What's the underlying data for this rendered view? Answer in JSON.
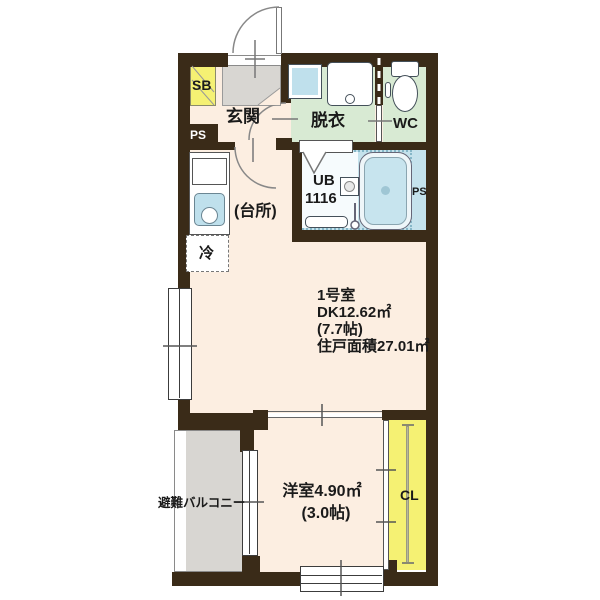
{
  "floorplan": {
    "unit_info": {
      "room_number": "1号室",
      "dk_area": "DK12.62㎡",
      "dk_tatami": "(7.7帖)",
      "total_area": "住戸面積27.01㎡"
    },
    "rooms": {
      "entrance": "玄関",
      "dressing_room": "脱衣",
      "toilet": "WC",
      "unit_bath_line1": "UB",
      "unit_bath_line2": "1116",
      "kitchen": "(台所)",
      "refrigerator": "冷",
      "western_room_area": "洋室4.90㎡",
      "western_room_tatami": "(3.0帖)",
      "balcony": "避難バルコニー",
      "closet": "CL",
      "shoe_box": "SB",
      "pipe_space_left": "PS",
      "pipe_space_right": "PS"
    },
    "colors": {
      "wall": "#3a2b18",
      "floor_beige": "#fceee1",
      "wet_area_green": "#d8ead3",
      "bath_blue": "#c5e2ec",
      "accent_yellow": "#f5f173",
      "concrete_gray": "#d8d6d2",
      "fixture_blue": "#bfe0ec"
    }
  }
}
